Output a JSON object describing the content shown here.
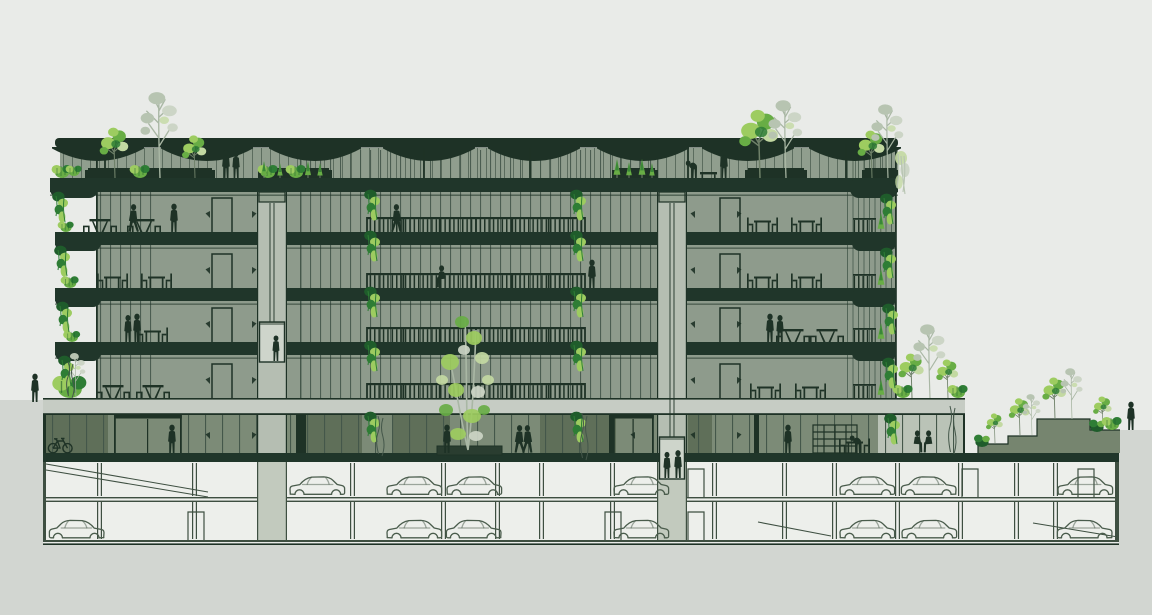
{
  "meta": {
    "title": "Architectural cross-section of a multi-storey green office building with roof canopy, planted terraces, central atrium bridges, elevator shafts, landscaped berm and two underground parking levels",
    "visible_text": "none"
  },
  "colors": {
    "sky": "#e9ebe8",
    "soil": "#d2d6d1",
    "ink": "#1e3226",
    "slab": "#20362a",
    "interior": "#8e9b8c",
    "clerestory": "#909e8e",
    "mull": "#44574a",
    "podium": "#c6ccc4",
    "shaft": "#b5beb2",
    "shaftB": "#c2cabe",
    "cab": "#ced5cb",
    "groundWall": "#7c8b77",
    "panelDark": "#5f6f59",
    "panelLight": "#bac3b7",
    "parking": "#edefeb",
    "pline": "#3e4f41",
    "car": "#4a5c4c",
    "berm": "#76856f",
    "greenL": "#9dcc60",
    "greenM": "#68ad45",
    "greenD": "#2e7d35",
    "greenDeep": "#1f5c2b",
    "pale": "#c3d9a2",
    "gray1": "#b7c4b1",
    "gray2": "#ccd5c6",
    "trunk": "#6f8169",
    "trunkG": "#a9b7a4",
    "header": "#94a291",
    "planterBox": "#2a3d30"
  },
  "geo": {
    "W": 1152,
    "H": 615,
    "soilPath": "M0,400 H43 V545 H1119 V430 H1152 V615 H0 Z",
    "tower": {
      "x1": 55,
      "x2": 898,
      "wallL": 96,
      "wallR": 895,
      "top": 150,
      "bottom": 398
    },
    "canopy": {
      "x1": 55,
      "x2": 898,
      "y": 138,
      "h": 9.5,
      "dishes": [
        98,
        207,
        315,
        429,
        534,
        643,
        748,
        855
      ],
      "columns": [
        104,
        423,
        529,
        687,
        845
      ]
    },
    "clerestory": {
      "x1": 60,
      "x2": 898,
      "y": 148,
      "h": 30
    },
    "roofSlab": {
      "x1": 50,
      "x2": 898,
      "y": 178,
      "h": 14
    },
    "slabY": [
      232,
      288,
      342
    ],
    "slabH": 13,
    "noseW": 46,
    "floorBases": [
      232,
      288,
      342,
      398
    ],
    "shafts": [
      {
        "x1": 257,
        "x2": 287,
        "cabY1": 322,
        "cabY2": 362
      },
      {
        "x1": 657,
        "x2": 687,
        "cabY1": 437,
        "cabY2": 479
      }
    ],
    "atrium": {
      "x1": 300,
      "x2": 657
    },
    "bridge": {
      "x1": 367,
      "x2": 585,
      "balY": [
        217,
        273,
        327,
        383
      ],
      "balH": 15
    },
    "podium": {
      "x1": 43,
      "x2": 965,
      "y": 398,
      "h": 17
    },
    "ground": {
      "x1": 43,
      "x2": 965,
      "top": 415,
      "base": 453,
      "slabX2": 1119,
      "slabH": 9
    },
    "basement": {
      "x1": 43,
      "x2": 1119,
      "iL": 46,
      "iR": 1115,
      "top": 462,
      "f1": 497,
      "f2": 500.6,
      "base": 540,
      "bot": 545,
      "columns": [
        97,
        192,
        350,
        441,
        495,
        539,
        610,
        712,
        782,
        832,
        895,
        958,
        1014,
        1053
      ],
      "ramps": [
        [
          46,
          464,
          208,
          492
        ],
        [
          46,
          470,
          208,
          497
        ],
        [
          758,
          522,
          831,
          536
        ],
        [
          1033,
          523,
          1118,
          537
        ]
      ],
      "doors": [
        [
          688,
          497
        ],
        [
          688,
          540
        ],
        [
          962,
          497
        ],
        [
          1078,
          497
        ],
        [
          188,
          540
        ],
        [
          605,
          540
        ]
      ]
    },
    "berm": {
      "poly": "978,453 978,444 1008,444 1008,436 1037,436 1037,419 1090,419 1090,430 1120,430 1120,453",
      "outline": "M978,453 V444 H1008 V436 H1037 V419 H1090 V430 H1120"
    },
    "groundDetail": {
      "panelsDark": [
        [
          46,
          62
        ],
        [
          300,
          62
        ],
        [
          392,
          58
        ],
        [
          540,
          76
        ],
        [
          688,
          24
        ]
      ],
      "panelsLight": [
        [
          878,
          86
        ]
      ],
      "pillars": [
        [
          296,
          10
        ],
        [
          609,
          5
        ],
        [
          754,
          5
        ]
      ],
      "doors": [
        [
          114,
          66
        ],
        [
          613,
          39
        ]
      ],
      "mullStep": 17,
      "mullSkip": [
        [
          110,
          184
        ],
        [
          609,
          656
        ],
        [
          655,
          690
        ]
      ]
    },
    "upperDoors": [
      [
        212,
        20
      ],
      [
        720,
        20
      ]
    ],
    "upperWedges": [
      [
        210,
        -1
      ],
      [
        252,
        1
      ],
      [
        695,
        -1
      ],
      [
        737,
        1
      ]
    ],
    "groundWedges": [
      [
        210,
        -1
      ],
      [
        252,
        1
      ],
      [
        635,
        -1
      ],
      [
        695,
        -1
      ],
      [
        737,
        1
      ],
      [
        893,
        -1
      ]
    ],
    "rightEdge": {
      "railX": 853,
      "railW": 23,
      "conifX": 881
    }
  },
  "entities": {
    "people": [
      [
        "stand",
        35,
        402,
        1,
        0
      ],
      [
        "stand",
        226,
        178,
        1,
        0
      ],
      [
        "stand",
        236,
        178,
        0.95,
        1
      ],
      [
        "lean",
        694,
        178,
        1,
        0
      ],
      [
        "stand",
        724,
        178,
        1,
        0
      ],
      [
        "walk",
        133,
        232,
        1,
        0
      ],
      [
        "stand",
        174,
        232,
        1,
        0
      ],
      [
        "walk",
        397,
        232,
        1,
        1
      ],
      [
        "sit",
        443,
        288,
        1,
        0
      ],
      [
        "stand",
        592,
        288,
        1,
        0
      ],
      [
        "stand",
        128,
        342,
        0.95,
        0
      ],
      [
        "stand",
        137,
        342,
        1,
        1
      ],
      [
        "stand",
        770,
        342,
        1,
        0
      ],
      [
        "stand",
        780,
        342,
        0.95,
        1
      ],
      [
        "stand",
        172,
        453,
        1,
        0
      ],
      [
        "stand",
        447,
        453,
        1,
        0
      ],
      [
        "walk",
        519,
        453,
        1,
        0
      ],
      [
        "walk",
        528,
        453,
        1,
        1
      ],
      [
        "stand",
        788,
        453,
        1,
        0
      ],
      [
        "lean",
        858,
        453,
        1,
        0
      ],
      [
        "sit",
        916,
        453,
        1,
        1
      ],
      [
        "sit",
        930,
        453,
        1,
        0
      ],
      [
        "stand",
        1131,
        430,
        1,
        0
      ]
    ],
    "cabPeople": [
      [
        "stand",
        276,
        361,
        0.9,
        0
      ],
      [
        "stand",
        667,
        478,
        0.92,
        0
      ],
      [
        "stand",
        678,
        478,
        0.98,
        1
      ]
    ],
    "carsP1": [
      [
        288,
        0
      ],
      [
        385,
        0
      ],
      [
        445,
        0
      ],
      [
        612,
        0
      ],
      [
        838,
        0
      ],
      [
        900,
        1
      ],
      [
        1056,
        0
      ]
    ],
    "carsP2": [
      [
        48,
        1
      ],
      [
        385,
        0
      ],
      [
        445,
        1
      ],
      [
        612,
        0
      ],
      [
        838,
        0
      ],
      [
        900,
        0
      ],
      [
        1056,
        1
      ]
    ],
    "picnic": [
      [
        100,
        232
      ],
      [
        144,
        232
      ],
      [
        113,
        398
      ],
      [
        153,
        398
      ],
      [
        793,
        342
      ],
      [
        827,
        342
      ]
    ],
    "dining": [
      [
        112,
        288
      ],
      [
        156,
        288
      ],
      [
        762,
        232
      ],
      [
        806,
        232
      ],
      [
        762,
        288
      ],
      [
        806,
        288
      ],
      [
        152,
        342
      ],
      [
        765,
        398
      ],
      [
        810,
        398
      ],
      [
        854,
        453
      ]
    ],
    "roofPlanters": [
      [
        85,
        130
      ],
      [
        258,
        74
      ],
      [
        612,
        46
      ],
      [
        745,
        62
      ],
      [
        862,
        36
      ]
    ],
    "roofBench": [
      700,
      178
    ],
    "trees": [
      [
        "gray",
        160,
        178,
        1.05
      ],
      [
        "light",
        115,
        178,
        0.85
      ],
      [
        "light",
        195,
        178,
        0.72
      ],
      [
        "shrub",
        140,
        178,
        1
      ],
      [
        "shrub",
        62,
        178,
        1
      ],
      [
        "shrub",
        74,
        176,
        0.8
      ],
      [
        "shrub",
        268,
        178,
        1
      ],
      [
        "conif",
        264,
        178,
        0.8
      ],
      [
        "conif",
        280,
        178,
        0.7
      ],
      [
        "shrub",
        296,
        178,
        1
      ],
      [
        "conif",
        308,
        178,
        0.8
      ],
      [
        "conif",
        320,
        178,
        0.7
      ],
      [
        "conif",
        617,
        178,
        0.9
      ],
      [
        "conif",
        629,
        178,
        0.75
      ],
      [
        "conif",
        642,
        178,
        0.9
      ],
      [
        "conif",
        652,
        178,
        0.7
      ],
      [
        "light",
        760,
        178,
        1.15
      ],
      [
        "gray",
        786,
        178,
        0.95
      ],
      [
        "light",
        872,
        178,
        0.8
      ],
      [
        "gray",
        888,
        178,
        0.9
      ],
      [
        "light",
        912,
        398,
        0.75
      ],
      [
        "gray",
        930,
        398,
        0.9
      ],
      [
        "light",
        948,
        398,
        0.65
      ],
      [
        "shrub",
        903,
        398,
        1
      ],
      [
        "shrub",
        958,
        398,
        1
      ],
      [
        "light",
        995,
        443,
        0.5
      ],
      [
        "light",
        1020,
        435,
        0.62
      ],
      [
        "gray",
        1032,
        435,
        0.5
      ],
      [
        "light",
        1055,
        419,
        0.7
      ],
      [
        "gray",
        1072,
        419,
        0.62
      ],
      [
        "light",
        1103,
        429,
        0.55
      ],
      [
        "shrubD",
        982,
        447,
        1
      ],
      [
        "shrubD",
        1097,
        432,
        1
      ],
      [
        "shrub",
        1112,
        430,
        1
      ]
    ],
    "leftPlants": [
      [
        66,
        232,
        0.8
      ],
      [
        70,
        288,
        0.9
      ],
      [
        72,
        342,
        0.85
      ]
    ],
    "podiumShrub": [
      70,
      398
    ],
    "hangs": [
      [
        372,
        192
      ],
      [
        578,
        192
      ],
      [
        372,
        233
      ],
      [
        578,
        233
      ],
      [
        372,
        289
      ],
      [
        578,
        289
      ],
      [
        372,
        343
      ],
      [
        578,
        343
      ],
      [
        372,
        414
      ],
      [
        578,
        414
      ],
      [
        60,
        194
      ],
      [
        62,
        248
      ],
      [
        64,
        304
      ],
      [
        66,
        358
      ],
      [
        888,
        196
      ],
      [
        888,
        250
      ],
      [
        890,
        306
      ],
      [
        890,
        360
      ],
      [
        892,
        416
      ]
    ],
    "vines": [
      [
        378,
        416,
        38
      ],
      [
        582,
        414,
        44
      ],
      [
        950,
        406,
        46
      ],
      [
        68,
        362,
        34
      ]
    ],
    "paleCascade": [
      901,
      152
    ],
    "atriumTree": {
      "x": 468,
      "base": 450
    },
    "groundPlanter": [
      437,
      446,
      65,
      9
    ],
    "bike": [
      48,
      453
    ],
    "shelf": [
      813,
      453
    ]
  }
}
